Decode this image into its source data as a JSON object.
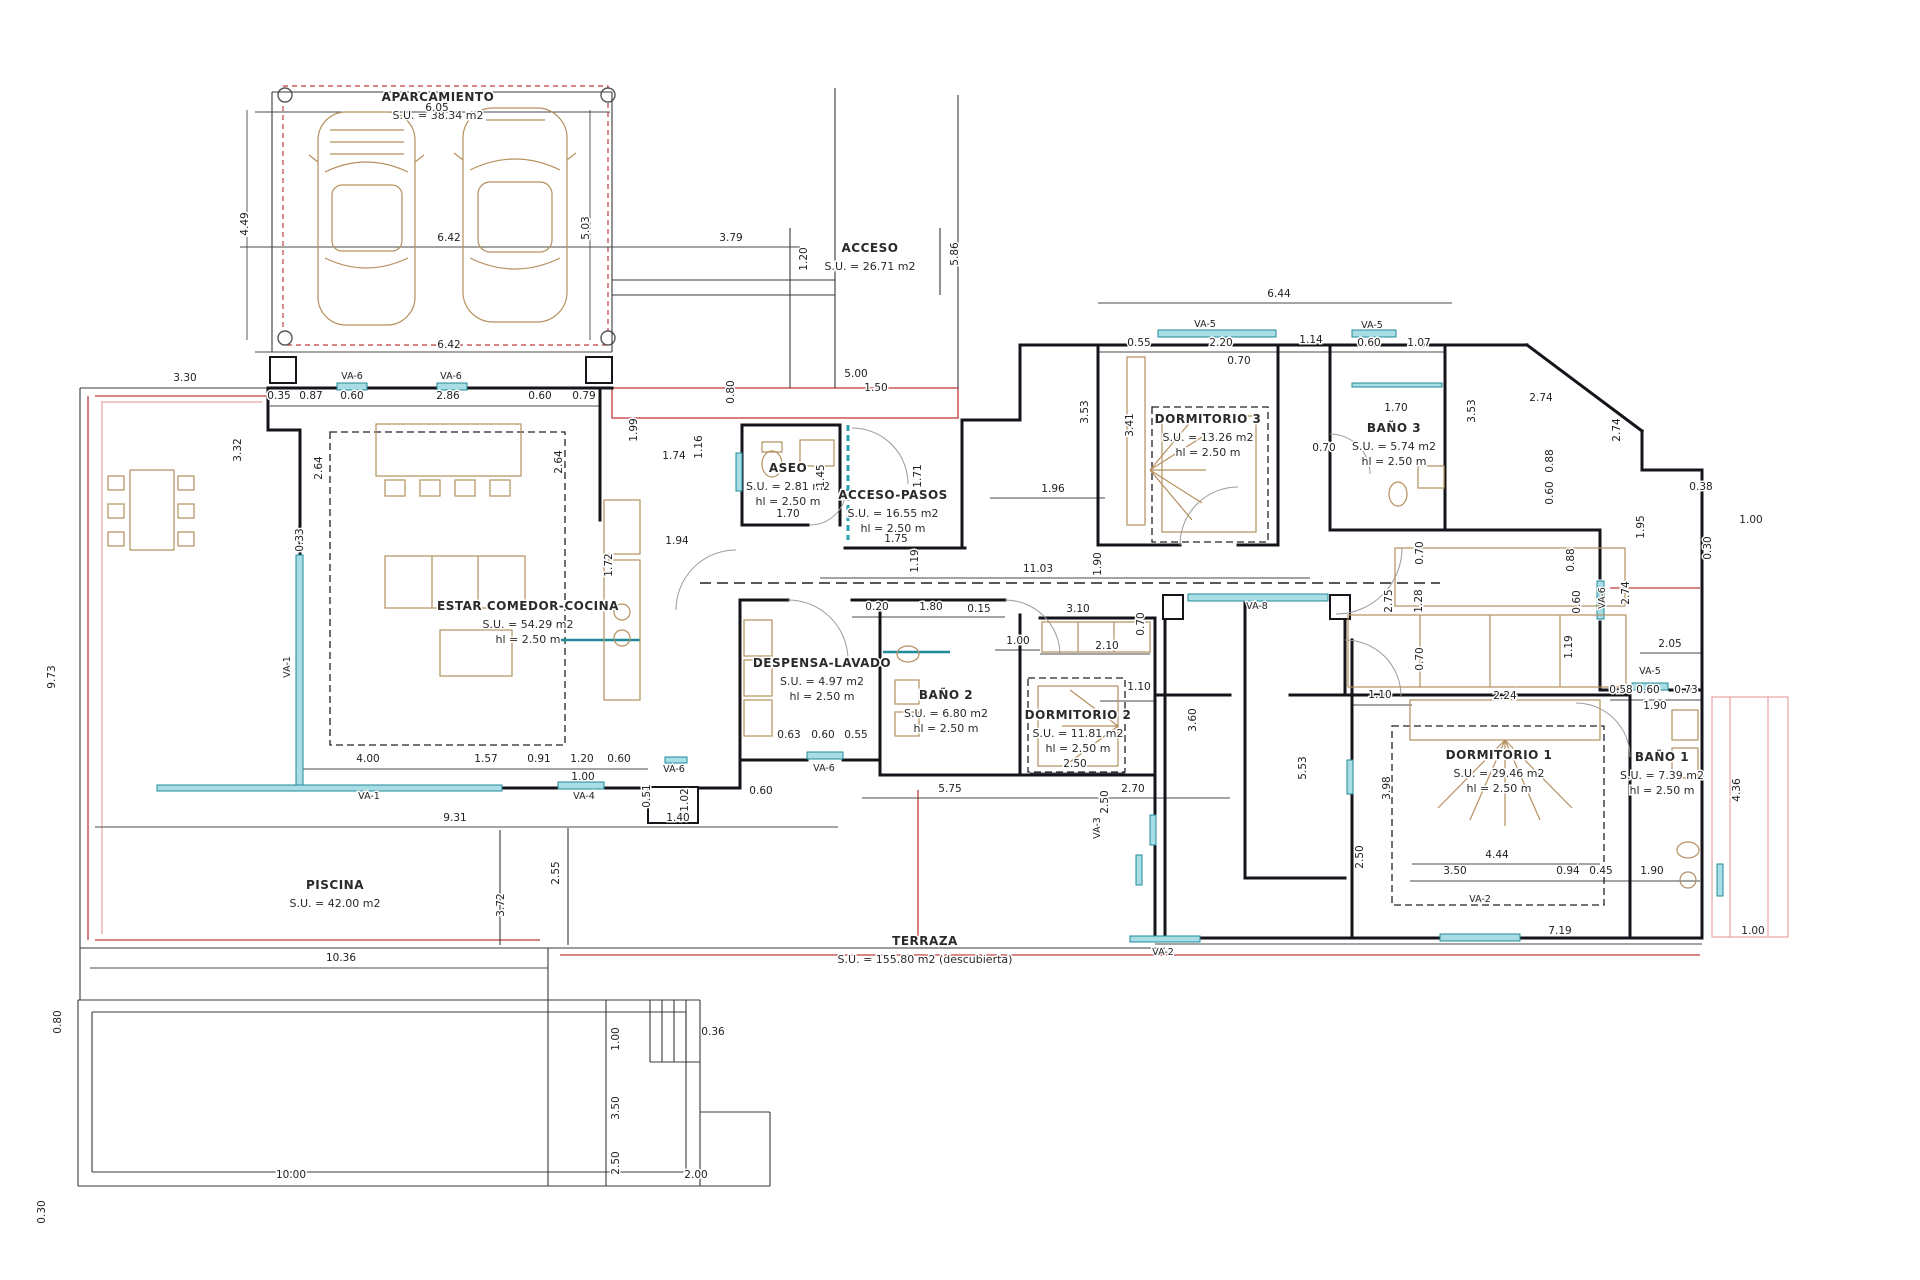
{
  "title": "Planta vivienda - distribucion",
  "colors": {
    "walls": "#14141a",
    "windows": "#a8dde6",
    "window_stroke": "#1f8a9a",
    "red_lines": "#c43c3c",
    "furniture": "#b5905e",
    "background": "#ffffff"
  },
  "rooms": [
    {
      "label": "APARCAMIENTO",
      "su": "S.U. = 38.34 m2",
      "hl": "",
      "x": 438,
      "y": 101
    },
    {
      "label": "ACCESO",
      "su": "S.U. = 26.71 m2",
      "hl": "",
      "x": 870,
      "y": 252
    },
    {
      "label": "ASEO",
      "su": "S.U. = 2.81 m2",
      "hl": "hl = 2.50 m",
      "x": 788,
      "y": 472
    },
    {
      "label": "ACCESO-PASOS",
      "su": "S.U. = 16.55 m2",
      "hl": "hl = 2.50 m",
      "x": 893,
      "y": 499
    },
    {
      "label": "DORMITORIO 3",
      "su": "S.U. = 13.26 m2",
      "hl": "hl = 2.50 m",
      "x": 1208,
      "y": 423
    },
    {
      "label": "BAÑO 3",
      "su": "S.U. = 5.74 m2",
      "hl": "hl = 2.50 m",
      "x": 1394,
      "y": 432
    },
    {
      "label": "ESTAR COMEDOR-COCINA",
      "su": "S.U. = 54.29 m2",
      "hl": "hl = 2.50 m",
      "x": 528,
      "y": 610
    },
    {
      "label": "DESPENSA-LAVADO",
      "su": "S.U. = 4.97 m2",
      "hl": "hl = 2.50 m",
      "x": 822,
      "y": 667
    },
    {
      "label": "BAÑO 2",
      "su": "S.U. = 6.80 m2",
      "hl": "hl = 2.50 m",
      "x": 946,
      "y": 699
    },
    {
      "label": "DORMITORIO 2",
      "su": "S.U. = 11.81 m2",
      "hl": "hl = 2.50 m",
      "x": 1078,
      "y": 719
    },
    {
      "label": "DORMITORIO 1",
      "su": "S.U. = 29.46 m2",
      "hl": "hl = 2.50 m",
      "x": 1499,
      "y": 759
    },
    {
      "label": "BAÑO 1",
      "su": "S.U. = 7.39 m2",
      "hl": "hl = 2.50 m",
      "x": 1662,
      "y": 761
    },
    {
      "label": "TERRAZA",
      "su": "S.U. = 155.80 m2 (descubierta)",
      "hl": "",
      "x": 925,
      "y": 945
    },
    {
      "label": "PISCINA",
      "su": "S.U. = 42.00 m2",
      "hl": "",
      "x": 335,
      "y": 889
    }
  ],
  "dims": [
    {
      "t": "6.05",
      "x": 437,
      "y": 111
    },
    {
      "t": "4.49",
      "x": 248,
      "y": 224,
      "r": 1
    },
    {
      "t": "6.42",
      "x": 449,
      "y": 241
    },
    {
      "t": "5.03",
      "x": 589,
      "y": 228,
      "r": 1
    },
    {
      "t": "6.42",
      "x": 449,
      "y": 348
    },
    {
      "t": "3.79",
      "x": 731,
      "y": 241
    },
    {
      "t": "1.20",
      "x": 807,
      "y": 259,
      "r": 1
    },
    {
      "t": "5.86",
      "x": 958,
      "y": 254,
      "r": 1
    },
    {
      "t": "5.00",
      "x": 856,
      "y": 377
    },
    {
      "t": "1.50",
      "x": 876,
      "y": 391
    },
    {
      "t": "3.30",
      "x": 185,
      "y": 381
    },
    {
      "t": "0.35",
      "x": 279,
      "y": 399
    },
    {
      "t": "0.87",
      "x": 311,
      "y": 399
    },
    {
      "t": "0.60",
      "x": 352,
      "y": 399
    },
    {
      "t": "2.86",
      "x": 448,
      "y": 399
    },
    {
      "t": "0.60",
      "x": 540,
      "y": 399
    },
    {
      "t": "0.79",
      "x": 584,
      "y": 399
    },
    {
      "t": "3.32",
      "x": 241,
      "y": 450,
      "r": 1
    },
    {
      "t": "2.64",
      "x": 322,
      "y": 468,
      "r": 1
    },
    {
      "t": "2.64",
      "x": 562,
      "y": 462,
      "r": 1
    },
    {
      "t": "0.33",
      "x": 303,
      "y": 540,
      "r": 1
    },
    {
      "t": "9.73",
      "x": 55,
      "y": 677,
      "r": 1
    },
    {
      "t": "4.00",
      "x": 368,
      "y": 762
    },
    {
      "t": "1.57",
      "x": 486,
      "y": 762
    },
    {
      "t": "0.91",
      "x": 539,
      "y": 762
    },
    {
      "t": "1.20",
      "x": 582,
      "y": 762
    },
    {
      "t": "0.60",
      "x": 619,
      "y": 762
    },
    {
      "t": "1.00",
      "x": 583,
      "y": 780
    },
    {
      "t": "9.31",
      "x": 455,
      "y": 821
    },
    {
      "t": "10.36",
      "x": 341,
      "y": 961
    },
    {
      "t": "2.55",
      "x": 559,
      "y": 873,
      "r": 1
    },
    {
      "t": "3.72",
      "x": 504,
      "y": 905,
      "r": 1
    },
    {
      "t": "1.99",
      "x": 637,
      "y": 430,
      "r": 1
    },
    {
      "t": "1.74",
      "x": 674,
      "y": 459
    },
    {
      "t": "1.16",
      "x": 702,
      "y": 447,
      "r": 1
    },
    {
      "t": "0.80",
      "x": 734,
      "y": 392,
      "r": 1
    },
    {
      "t": "1.45",
      "x": 824,
      "y": 476,
      "r": 1
    },
    {
      "t": "1.70",
      "x": 788,
      "y": 517
    },
    {
      "t": "1.75",
      "x": 896,
      "y": 542
    },
    {
      "t": "1.71",
      "x": 921,
      "y": 476,
      "r": 1
    },
    {
      "t": "1.94",
      "x": 677,
      "y": 544
    },
    {
      "t": "1.72",
      "x": 612,
      "y": 565,
      "r": 1
    },
    {
      "t": "6.44",
      "x": 1279,
      "y": 297
    },
    {
      "t": "0.55",
      "x": 1139,
      "y": 346
    },
    {
      "t": "2.20",
      "x": 1221,
      "y": 346
    },
    {
      "t": "1.14",
      "x": 1311,
      "y": 343
    },
    {
      "t": "0.60",
      "x": 1369,
      "y": 346
    },
    {
      "t": "1.07",
      "x": 1419,
      "y": 346
    },
    {
      "t": "3.53",
      "x": 1088,
      "y": 412,
      "r": 1
    },
    {
      "t": "3.41",
      "x": 1133,
      "y": 425,
      "r": 1
    },
    {
      "t": "0.70",
      "x": 1239,
      "y": 364
    },
    {
      "t": "0.70",
      "x": 1324,
      "y": 451
    },
    {
      "t": "3.53",
      "x": 1475,
      "y": 411,
      "r": 1
    },
    {
      "t": "1.70",
      "x": 1396,
      "y": 411
    },
    {
      "t": "2.74",
      "x": 1541,
      "y": 401
    },
    {
      "t": "0.88",
      "x": 1553,
      "y": 461,
      "r": 1
    },
    {
      "t": "0.60",
      "x": 1553,
      "y": 493,
      "r": 1
    },
    {
      "t": "2.74",
      "x": 1620,
      "y": 430,
      "r": 1
    },
    {
      "t": "0.88",
      "x": 1574,
      "y": 560,
      "r": 1
    },
    {
      "t": "0.60",
      "x": 1580,
      "y": 602,
      "r": 1
    },
    {
      "t": "1.19",
      "x": 1572,
      "y": 647,
      "r": 1
    },
    {
      "t": "2.74",
      "x": 1629,
      "y": 593,
      "r": 1
    },
    {
      "t": "2.05",
      "x": 1670,
      "y": 647
    },
    {
      "t": "0.38",
      "x": 1701,
      "y": 490
    },
    {
      "t": "1.00",
      "x": 1751,
      "y": 523
    },
    {
      "t": "0.30",
      "x": 1711,
      "y": 548,
      "r": 1
    },
    {
      "t": "1.95",
      "x": 1644,
      "y": 527,
      "r": 1
    },
    {
      "t": "0.58",
      "x": 1621,
      "y": 693
    },
    {
      "t": "0.60",
      "x": 1648,
      "y": 693
    },
    {
      "t": "0.73",
      "x": 1686,
      "y": 693
    },
    {
      "t": "1.90",
      "x": 1655,
      "y": 709
    },
    {
      "t": "11.03",
      "x": 1038,
      "y": 572
    },
    {
      "t": "1.19",
      "x": 918,
      "y": 561,
      "r": 1
    },
    {
      "t": "1.96",
      "x": 1053,
      "y": 492
    },
    {
      "t": "1.90",
      "x": 1101,
      "y": 564,
      "r": 1
    },
    {
      "t": "0.20",
      "x": 877,
      "y": 610
    },
    {
      "t": "1.80",
      "x": 931,
      "y": 610
    },
    {
      "t": "0.15",
      "x": 979,
      "y": 612
    },
    {
      "t": "3.10",
      "x": 1078,
      "y": 612
    },
    {
      "t": "1.00",
      "x": 1018,
      "y": 644
    },
    {
      "t": "2.10",
      "x": 1107,
      "y": 649
    },
    {
      "t": "0.70",
      "x": 1144,
      "y": 624,
      "r": 1
    },
    {
      "t": "0.63",
      "x": 789,
      "y": 738
    },
    {
      "t": "0.60",
      "x": 823,
      "y": 738
    },
    {
      "t": "0.55",
      "x": 856,
      "y": 738
    },
    {
      "t": "2.50",
      "x": 1075,
      "y": 767
    },
    {
      "t": "5.75",
      "x": 950,
      "y": 792
    },
    {
      "t": "2.70",
      "x": 1133,
      "y": 792
    },
    {
      "t": "1.40",
      "x": 678,
      "y": 821
    },
    {
      "t": "0.60",
      "x": 761,
      "y": 794
    },
    {
      "t": "0.51",
      "x": 650,
      "y": 796,
      "r": 1
    },
    {
      "t": "1.02",
      "x": 688,
      "y": 800,
      "r": 1
    },
    {
      "t": "2.75",
      "x": 1392,
      "y": 601,
      "r": 1
    },
    {
      "t": "1.28",
      "x": 1422,
      "y": 601,
      "r": 1
    },
    {
      "t": "0.70",
      "x": 1423,
      "y": 553,
      "r": 1
    },
    {
      "t": "0.70",
      "x": 1423,
      "y": 659,
      "r": 1
    },
    {
      "t": "1.10",
      "x": 1139,
      "y": 690
    },
    {
      "t": "1.10",
      "x": 1380,
      "y": 698
    },
    {
      "t": "2.24",
      "x": 1505,
      "y": 699
    },
    {
      "t": "3.60",
      "x": 1196,
      "y": 720,
      "r": 1
    },
    {
      "t": "5.53",
      "x": 1306,
      "y": 768,
      "r": 1
    },
    {
      "t": "2.50",
      "x": 1108,
      "y": 802,
      "r": 1
    },
    {
      "t": "2.50",
      "x": 1363,
      "y": 857,
      "r": 1
    },
    {
      "t": "3.98",
      "x": 1390,
      "y": 788,
      "r": 1
    },
    {
      "t": "4.44",
      "x": 1497,
      "y": 858
    },
    {
      "t": "3.50",
      "x": 1455,
      "y": 874
    },
    {
      "t": "0.94",
      "x": 1568,
      "y": 874
    },
    {
      "t": "0.45",
      "x": 1601,
      "y": 874
    },
    {
      "t": "1.90",
      "x": 1652,
      "y": 874
    },
    {
      "t": "7.19",
      "x": 1560,
      "y": 934
    },
    {
      "t": "1.00",
      "x": 1753,
      "y": 934
    },
    {
      "t": "4.36",
      "x": 1740,
      "y": 790,
      "r": 1
    },
    {
      "t": "0.80",
      "x": 61,
      "y": 1022,
      "r": 1
    },
    {
      "t": "0.30",
      "x": 45,
      "y": 1212,
      "r": 1
    },
    {
      "t": "10.00",
      "x": 291,
      "y": 1178
    },
    {
      "t": "2.00",
      "x": 696,
      "y": 1178
    },
    {
      "t": "1.00",
      "x": 619,
      "y": 1039,
      "r": 1
    },
    {
      "t": "3.50",
      "x": 619,
      "y": 1108,
      "r": 1
    },
    {
      "t": "2.50",
      "x": 619,
      "y": 1163,
      "r": 1
    },
    {
      "t": "0.36",
      "x": 713,
      "y": 1035
    }
  ],
  "windows": [
    {
      "t": "VA-6",
      "x": 352,
      "y": 379
    },
    {
      "t": "VA-6",
      "x": 451,
      "y": 379
    },
    {
      "t": "VA-5",
      "x": 1205,
      "y": 327
    },
    {
      "t": "VA-5",
      "x": 1372,
      "y": 328
    },
    {
      "t": "VA-8",
      "x": 1257,
      "y": 609
    },
    {
      "t": "VA-6",
      "x": 824,
      "y": 771
    },
    {
      "t": "VA-6",
      "x": 674,
      "y": 772
    },
    {
      "t": "VA-4",
      "x": 584,
      "y": 799
    },
    {
      "t": "VA-1",
      "x": 369,
      "y": 799
    },
    {
      "t": "VA-1",
      "x": 290,
      "y": 667,
      "r": 1
    },
    {
      "t": "VA-2",
      "x": 1480,
      "y": 902
    },
    {
      "t": "VA-3",
      "x": 1100,
      "y": 828,
      "r": 1
    },
    {
      "t": "VA-5",
      "x": 1650,
      "y": 674
    },
    {
      "t": "VA-6",
      "x": 1605,
      "y": 598,
      "r": 1
    },
    {
      "t": "VA-2",
      "x": 1163,
      "y": 955
    }
  ]
}
